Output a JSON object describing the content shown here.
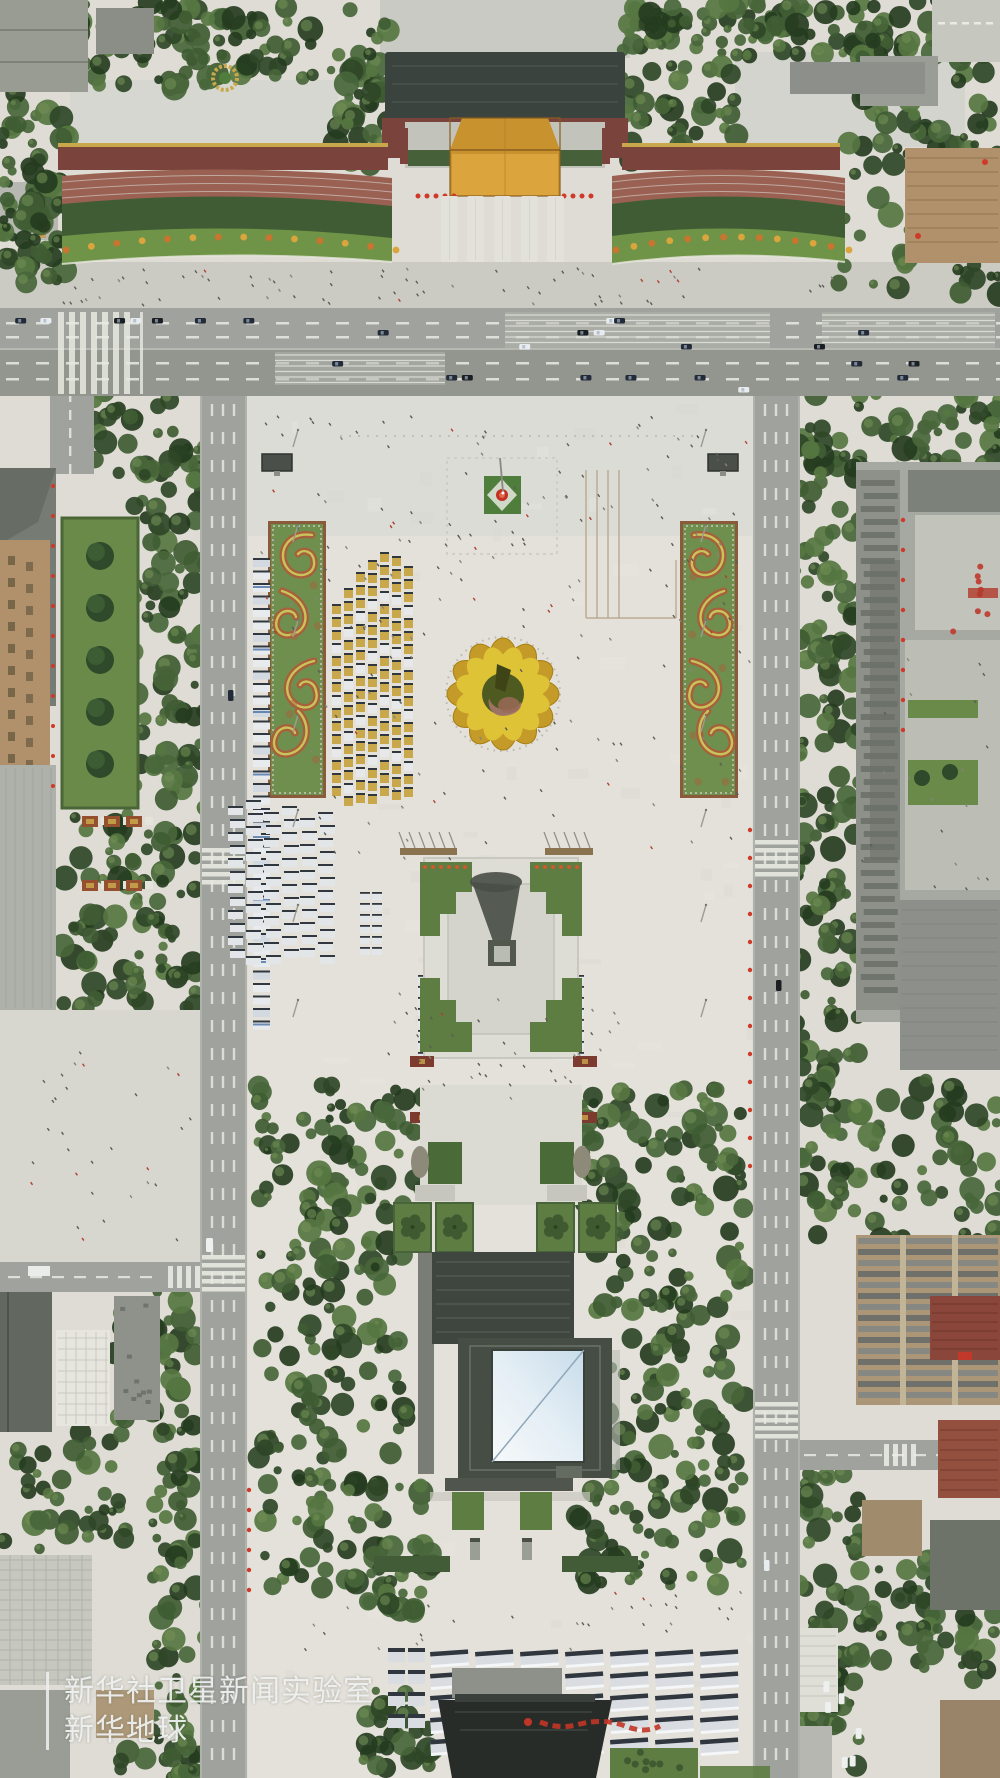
{
  "watermark": {
    "line1": "新华社卫星新闻实验室",
    "line2": "新华地球"
  },
  "colors": {
    "pavement": "#dedcd4",
    "plaza": "#e3e1d9",
    "sidewalk": "#cbcbc3",
    "road": "#a0a29d",
    "road_dark": "#93958f",
    "lane": "#edefe8",
    "tree_dark": "#2f4727",
    "tree_mid": "#3f5c33",
    "tree_light": "#567641",
    "lawn": "#5d7d42",
    "garden": "#698a49",
    "hedge": "#6f9447",
    "bed_green": "#6f8f4e",
    "bed_red": "#a85f3b",
    "bed_yellow": "#c9c45a",
    "gate_gold": "#c8922f",
    "gate_gold_bright": "#dca43c",
    "roof_dark": "#3a433d",
    "wall_red": "#7a443c",
    "stand_red": "#9a6152",
    "gold": "#c9a84c",
    "bldg_gray": "#a6a9a1",
    "bldg_dark": "#6d726b",
    "bldg_light": "#c6c7bf",
    "tan": "#b0916b",
    "maus_roof": "#454d44",
    "skylight_hi": "#f4f8fa",
    "skylight_lo": "#c8dcea",
    "red": "#cf3a28",
    "bus_body": "#d9dde1",
    "bus_dark": "#31373f",
    "white": "#eef0f0",
    "people": "#5c5c54",
    "shadow": "#4a4f48"
  }
}
